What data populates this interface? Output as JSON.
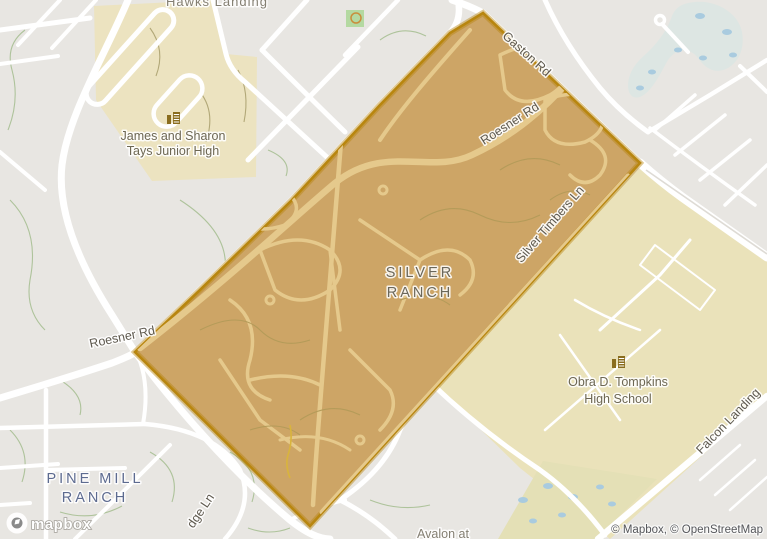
{
  "map_title": "Silver Ranch neighborhood map",
  "logo_text": "mapbox",
  "attribution": "© Mapbox, © OpenStreetMap",
  "labels": {
    "hawks_landing": "Hawks Landing",
    "silver_ranch_1": "SILVER",
    "silver_ranch_2": "RANCH",
    "pine_mill_1": "PINE MILL",
    "pine_mill_2": "RANCH",
    "avalon_partial": "Avalon at",
    "tays_1": "James and Sharon",
    "tays_2": "Tays Junior High",
    "tompkins_1": "Obra D. Tompkins",
    "tompkins_2": "High School"
  },
  "roads": {
    "gaston": "Gaston Rd",
    "roesner_inner": "Roesner Rd",
    "roesner_outer": "Roesner Rd",
    "silver_timbers": "Silver Timbers Ln",
    "falcon_landing": "Falcon Landing",
    "ridge_partial": "dge Ln"
  },
  "colors": {
    "land": "#e8e6e2",
    "road": "#ffffff",
    "school_area": "#ece3c0",
    "school_area_right": "#eae2ba",
    "park": "#b4d9a1",
    "water": "#dde6e3",
    "water_dots": "#a9cbdf",
    "wetland_band": "#e4e0b6",
    "highlight_fill": "#cda566",
    "highlight_border": "#b8860f",
    "highlight_street": "#e5c98c",
    "label_road": "#5e594e",
    "label_school": "#6d6753",
    "label_silver_ranch": "#6b675a",
    "label_pine_mill": "#5d6b90",
    "label_faded": "#847f72",
    "school_icon": "#8a6d1e"
  }
}
